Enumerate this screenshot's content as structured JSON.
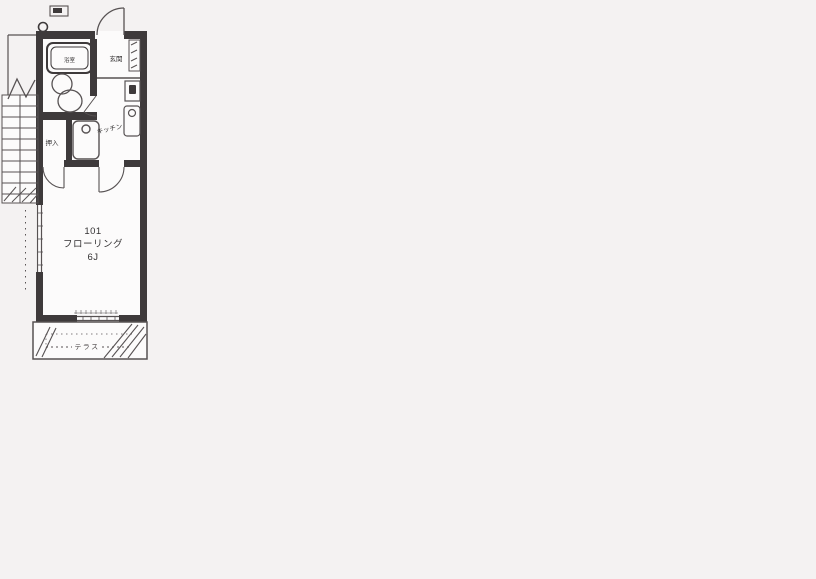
{
  "page": {
    "background": "#f4f2f2",
    "description_type": "scanned apartment floor plan"
  },
  "floorplan": {
    "room_number": "101",
    "flooring_label": "フローリング",
    "size_label": "6J",
    "labels": {
      "entrance": "玄関",
      "bath": "浴室",
      "closet": "押入",
      "kitchen": "キッチン",
      "terrace": "テラス"
    },
    "colors": {
      "wall": "#3e3a3b",
      "line": "#575253",
      "paper": "#f4f2f2",
      "room": "#fcfbfb",
      "text": "#333132"
    }
  }
}
